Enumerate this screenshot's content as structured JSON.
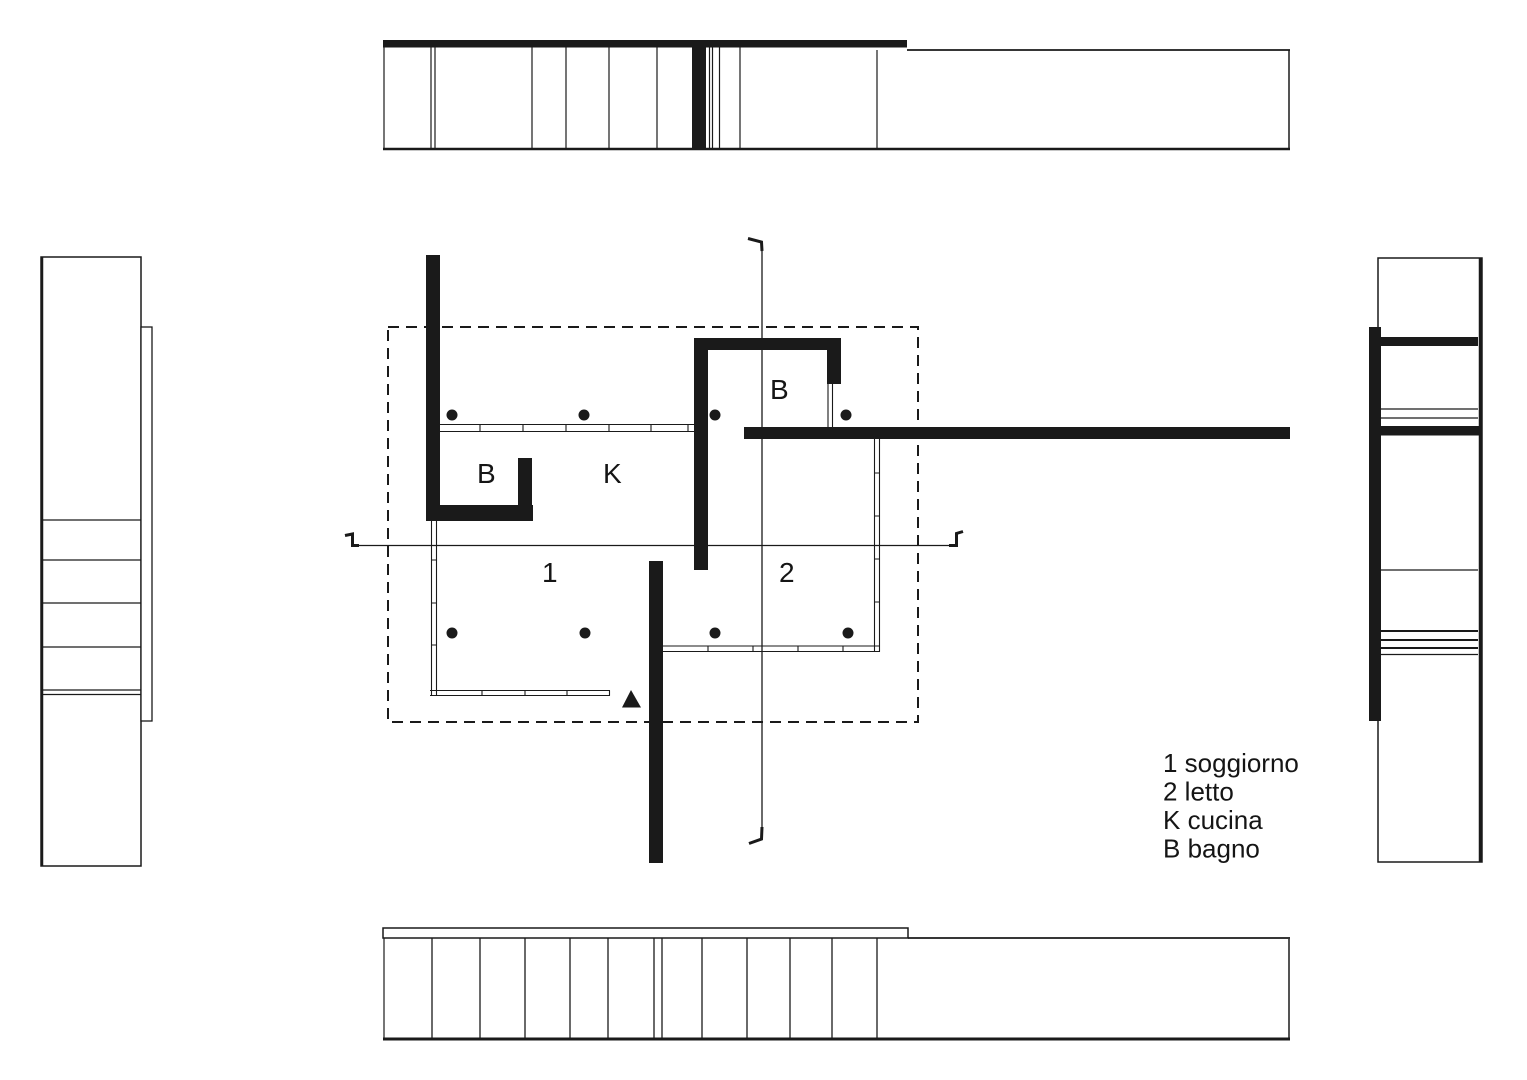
{
  "colors": {
    "ink": "#1a1a1a",
    "paper": "#ffffff"
  },
  "plan": {
    "labels": {
      "bath_upper": "B",
      "bath_lower": "B",
      "kitchen": "K",
      "living": "1",
      "bedroom": "2"
    }
  },
  "legend": {
    "items": [
      "1 soggiorno",
      "2 letto",
      "K cucina",
      "B bagno"
    ]
  },
  "icons": {
    "entrance_marker": "filled-triangle-up",
    "column_marker": "filled-dot",
    "section_cut_marker": "hooked-section-line",
    "roof_edge": "dashed-rectangle"
  }
}
